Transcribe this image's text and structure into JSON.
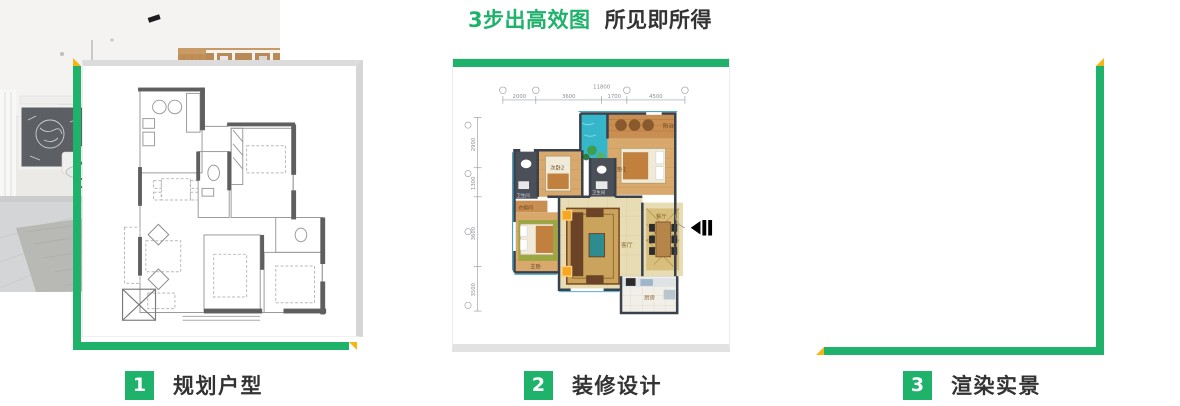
{
  "title": {
    "highlight": "3步出高效图",
    "rest": "所见即所得"
  },
  "colors": {
    "accent_green": "#1fb26b",
    "accent_yellow": "#f6b511",
    "text_dark": "#333333"
  },
  "steps": [
    {
      "number": "1",
      "label": "规划户型"
    },
    {
      "number": "2",
      "label": "装修设计"
    },
    {
      "number": "3",
      "label": "渲染实景"
    }
  ],
  "floorplan": {
    "dims_top": {
      "total": "11800",
      "segments": [
        "2000",
        "3600",
        "1700",
        "4500"
      ]
    },
    "dims_left": {
      "segments": [
        "2900",
        "1300",
        "3600",
        "3500"
      ]
    },
    "rooms": {
      "balcony": "阳台",
      "bedroom1": "次卧1",
      "bedroom2": "次卧2",
      "bath1": "卫生间",
      "bath2": "卫生间",
      "cloak": "衣帽间",
      "master": "主卧",
      "living": "客厅",
      "dining": "餐厅",
      "kitchen": "厨房"
    }
  }
}
